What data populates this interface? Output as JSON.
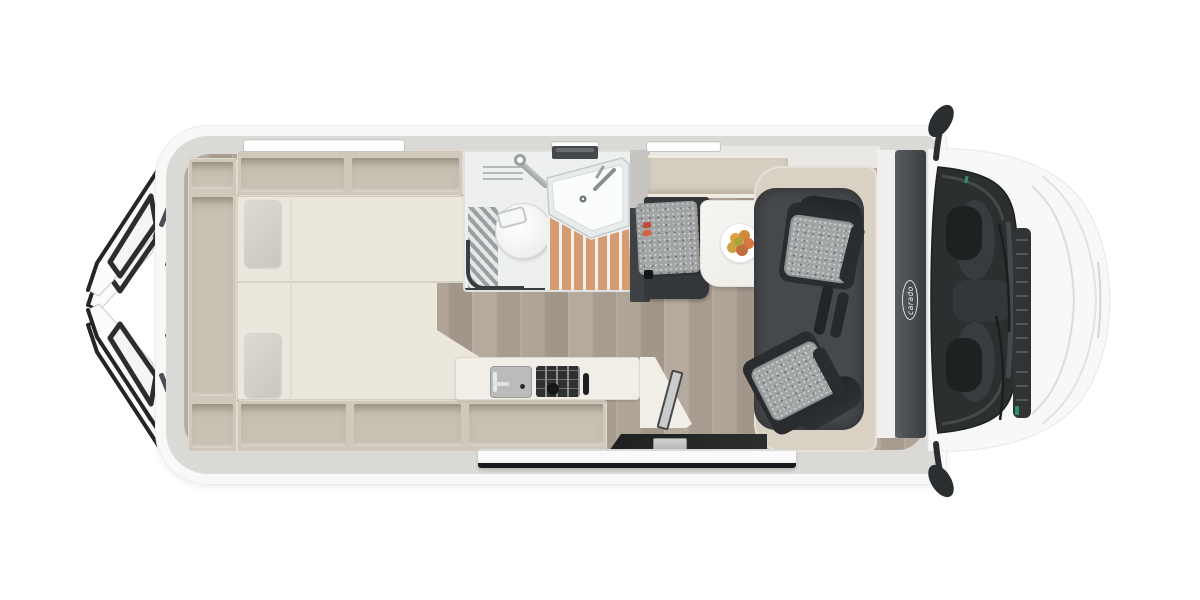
{
  "brand": {
    "logo_text": "carado"
  },
  "palette": {
    "body_white": "#f8f8f8",
    "wall_gray": "#dbd9d5",
    "cabinet_beige": "#cfc8bb",
    "mattress_cream": "#ebe7dd",
    "wood_floor": "#b1a599",
    "shower_slats": "#d59c72",
    "upholstery_gray": "#a2a5a6",
    "frame_charcoal": "#34373a",
    "cab_floor": "#46494c",
    "windshield_glass": "#2c2f30",
    "seatbelt_red": "#c64a30",
    "fruit_orange": "#dfa23e",
    "table_white": "#f4f3ee"
  }
}
